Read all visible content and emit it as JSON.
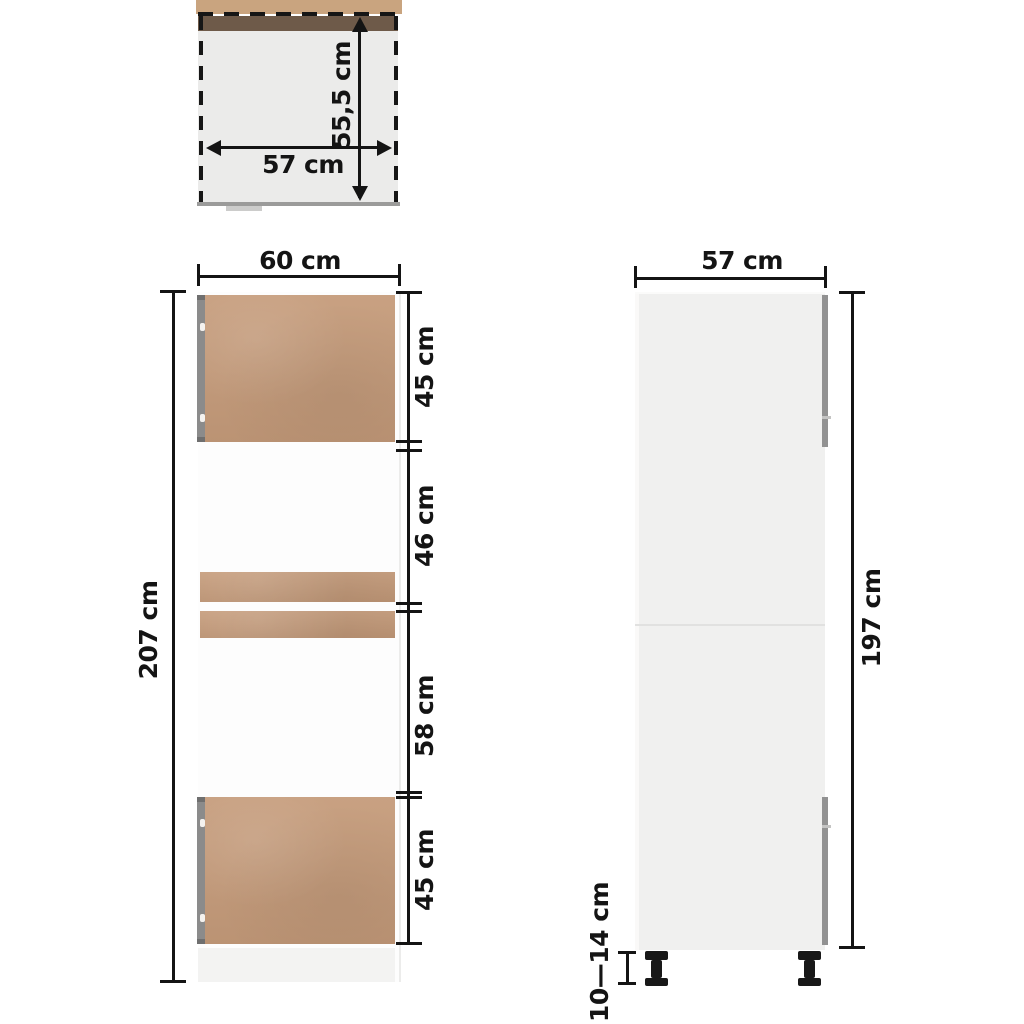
{
  "diagram": {
    "type": "furniture-dimension-diagram",
    "subject": "tall kitchen cabinet for built-in microwave / oven",
    "units": "cm"
  },
  "colors": {
    "wood": "#c59b7a",
    "wood_dark_edge": "#6e5a49",
    "worktop_tan": "#c9a47f",
    "hinge_gray": "#8b8b8b",
    "side_body_gray": "#f0f0ef",
    "dimension_ink": "#141414",
    "leg_black": "#181818"
  },
  "top_view": {
    "depth_label": "55,5 cm",
    "width_label": "57 cm"
  },
  "front_view": {
    "width_label": "60 cm",
    "height_label": "207 cm",
    "section_labels": [
      "45 cm",
      "46 cm",
      "58 cm",
      "45 cm"
    ]
  },
  "side_view": {
    "width_label": "57 cm",
    "height_label": "197 cm",
    "leg_height_label": "10—14 cm"
  }
}
